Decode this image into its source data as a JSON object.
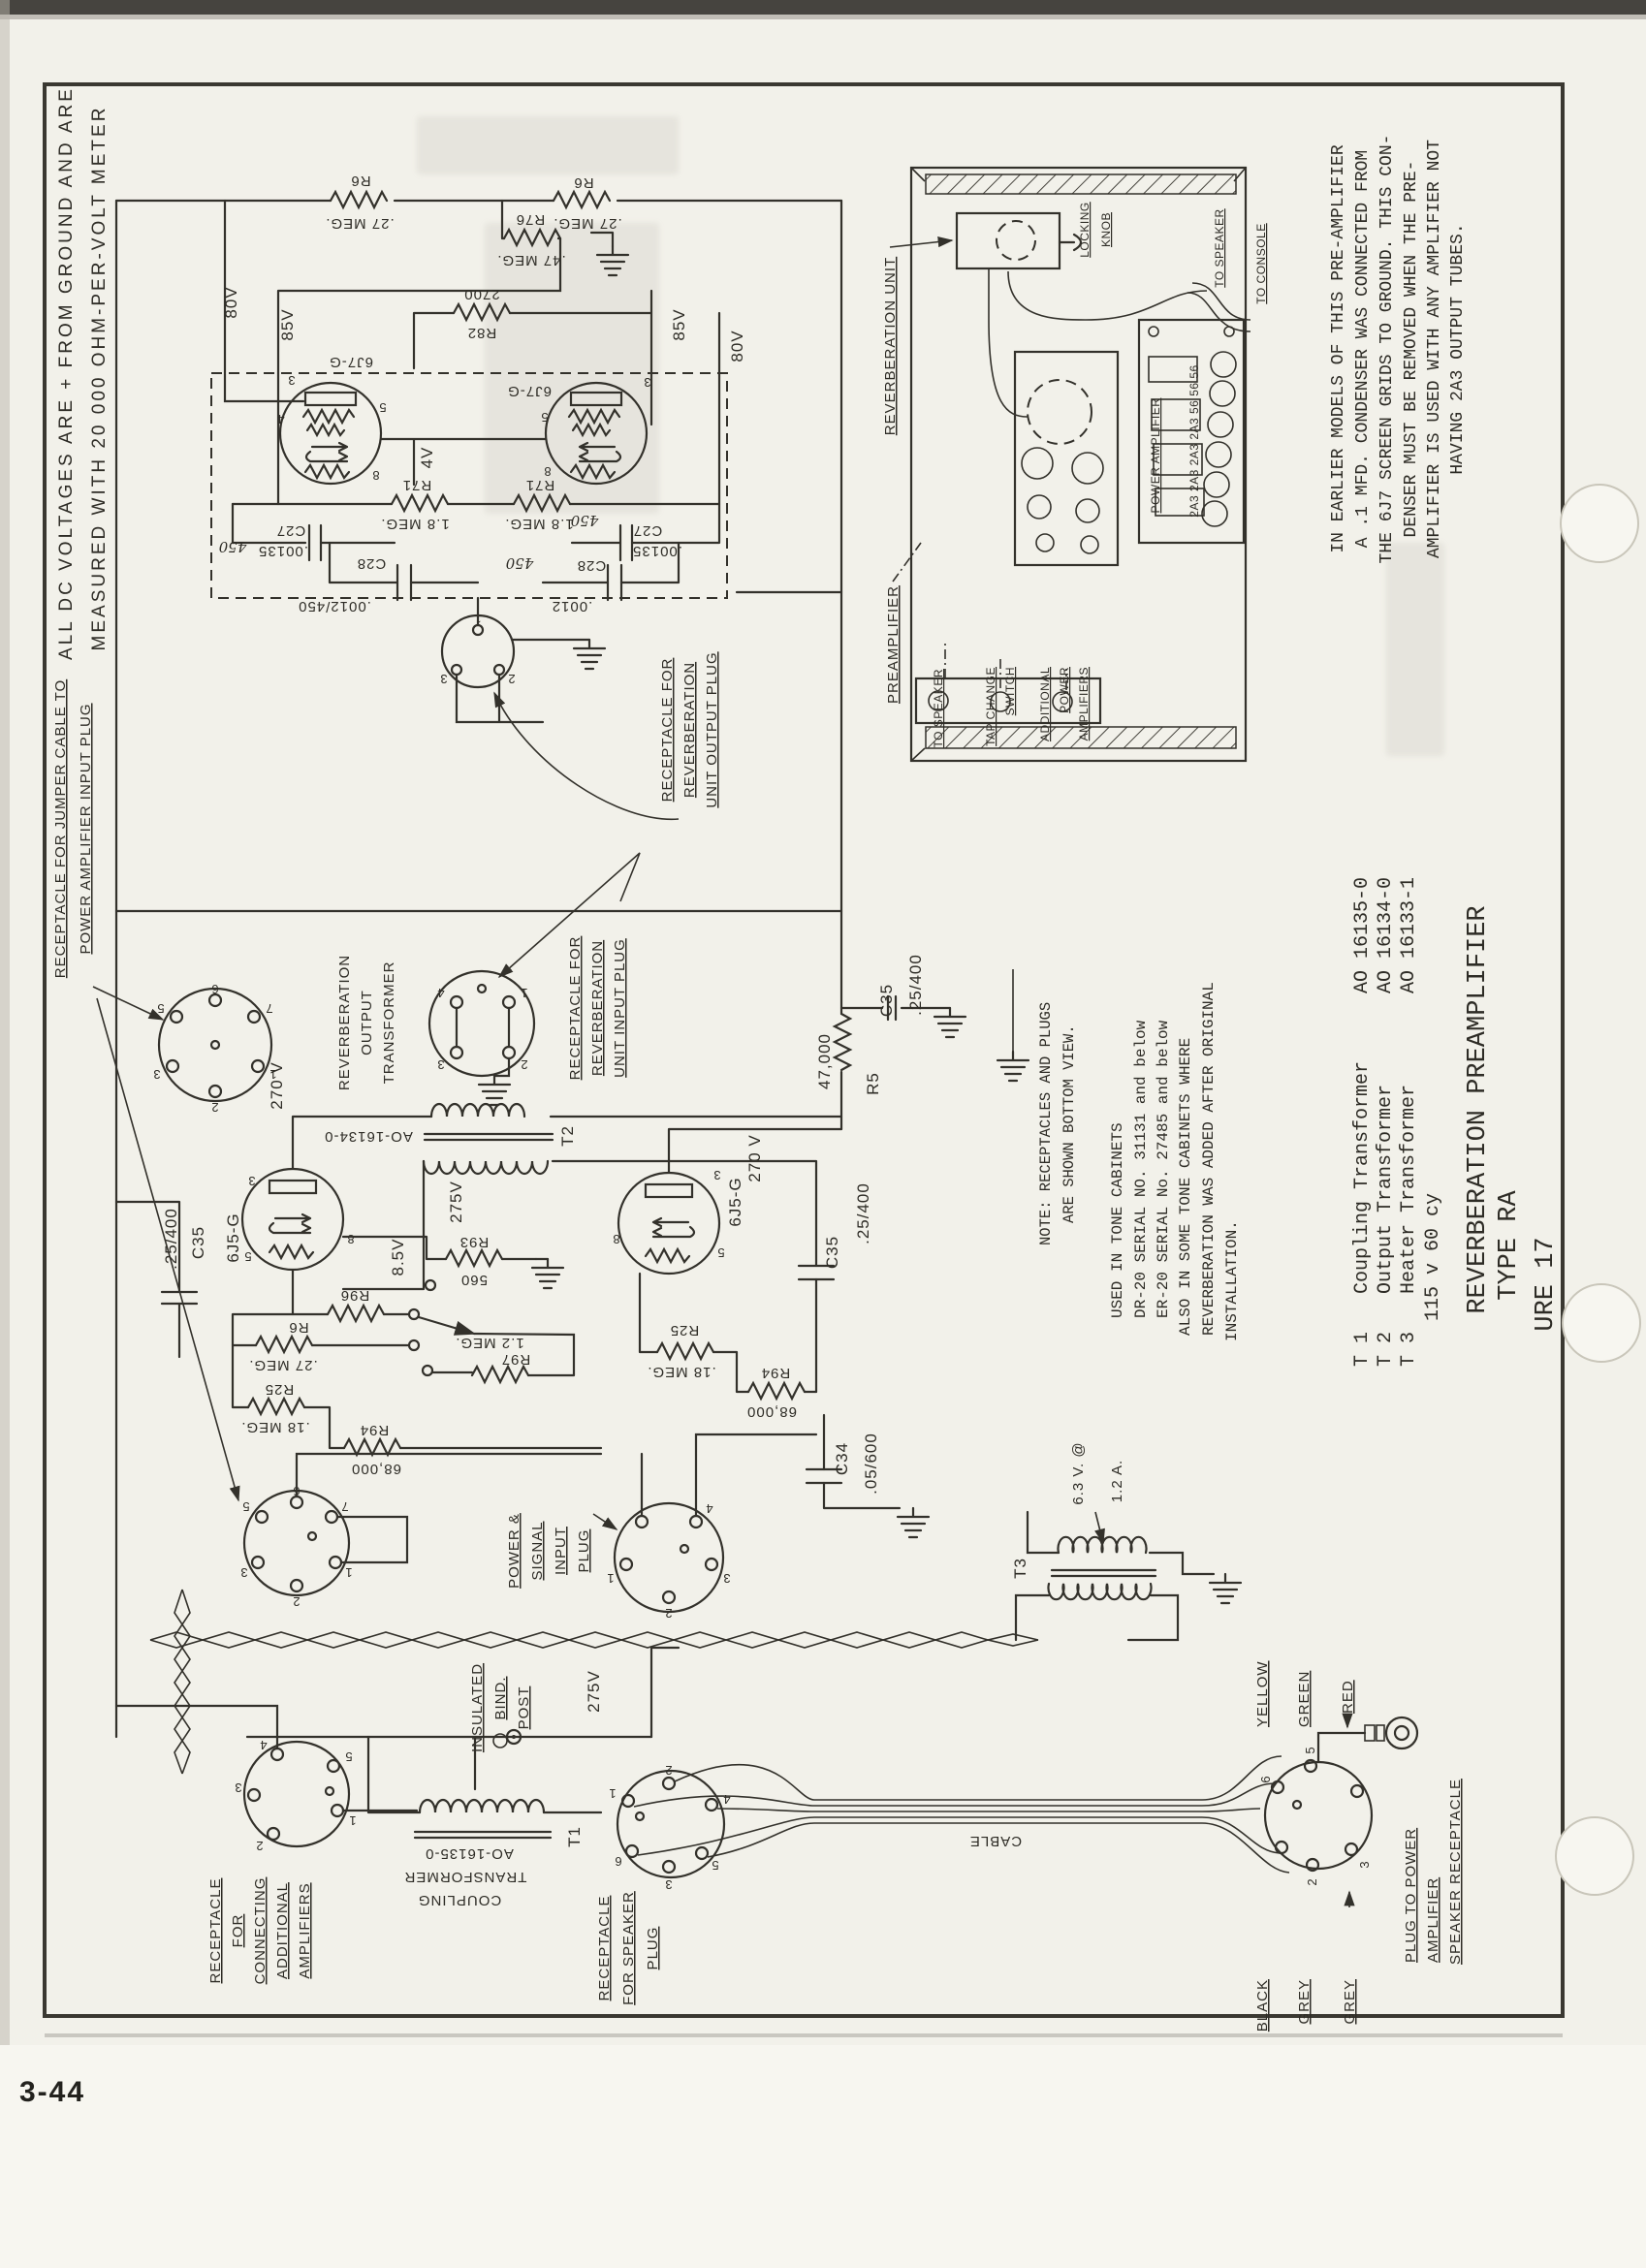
{
  "page": {
    "number": "3-44"
  },
  "caption": {
    "title": "REVERBERATION PREAMPLIFIER",
    "type": "TYPE RA",
    "figure": "URE 17"
  },
  "header": {
    "line1": "ALL DC VOLTAGES ARE + FROM GROUND AND ARE",
    "line2": "MEASURED WITH 20 000 OHM-PER-VOLT METER"
  },
  "notes": {
    "earlier_models": [
      "IN EARLIER MODELS OF THIS PRE-AMPLIFIER",
      "A .1 MFD. CONDENSER WAS CONNECTED FROM",
      "THE 6J7 SCREEN GRIDS TO GROUND.  THIS CON-",
      "DENSER MUST BE REMOVED WHEN THE PRE-",
      "AMPLIFIER IS USED WITH ANY AMPLIFIER NOT",
      "HAVING 2A3 OUTPUT TUBES."
    ],
    "bottom_view": [
      "NOTE:  RECEPTACLES AND PLUGS",
      "ARE SHOWN BOTTOM VIEW."
    ],
    "used_in": [
      "USED IN TONE CABINETS",
      "DR-20  SERIAL NO. 31131 and below",
      "ER-20  SERIAL No. 27485 and below",
      "ALSO IN SOME TONE CABINETS WHERE",
      "REVERBERATION WAS ADDED AFTER ORIGINAL",
      "INSTALLATION."
    ]
  },
  "table": {
    "rows": [
      {
        "id": "T 1",
        "name": "Coupling Transformer",
        "part": "AO 16135-0"
      },
      {
        "id": "T 2",
        "name": "Output Transformer",
        "part": "AO 16134-0"
      },
      {
        "id": "T 3",
        "name": "Heater Transformer",
        "part": "AO 16133-1"
      }
    ],
    "footer": "115 v 60 cy"
  },
  "callouts": {
    "jumper": [
      "RECEPTACLE FOR JUMPER CABLE TO",
      "POWER AMPLIFIER INPUT PLUG"
    ],
    "reverb_out_receptacle": [
      "RECEPTACLE FOR",
      "REVERBERATION",
      "UNIT OUTPUT PLUG"
    ],
    "reverb_out_transformer": [
      "REVERBERATION",
      "OUTPUT",
      "TRANSFORMER"
    ],
    "reverb_in_receptacle": [
      "RECEPTACLE FOR",
      "REVERBERATION",
      "UNIT INPUT PLUG"
    ],
    "power_signal_plug": [
      "POWER &",
      "SIGNAL",
      "INPUT",
      "PLUG"
    ],
    "bind_post": [
      "INSULATED",
      "BIND.",
      "POST"
    ],
    "additional_amps": [
      "RECEPTACLE",
      "FOR",
      "CONNECTING",
      "ADDITIONAL",
      "AMPLIFIERS"
    ],
    "speaker_receptacle": [
      "RECEPTACLE",
      "FOR SPEAKER",
      "PLUG"
    ],
    "power_amp_plug": [
      "PLUG TO POWER",
      "AMPLIFIER",
      "SPEAKER RECEPTACLE"
    ],
    "cable": "CABLE"
  },
  "illustration": {
    "reverberation_unit": "REVERBERATION UNIT",
    "locking_knob": [
      "LOCKING",
      "KNOB"
    ],
    "to_speaker": "TO SPEAKER",
    "to_console": "TO CONSOLE",
    "power_amplifier": "POWER AMPLIFIER",
    "output_tubes": "2A3 2A3 2A3 2A3 56 56 56",
    "preamplifier": "PREAMPLIFIER",
    "to_speaker_lower": "TO SPEAKER",
    "tap_change_switch": [
      "TAP CHANGE",
      "SWITCH"
    ],
    "additional_power_amplifiers": [
      "ADDITIONAL",
      "POWER",
      "AMPLIFIERS"
    ]
  },
  "tubes": {
    "pentode": "6J7-G",
    "triode": "6J5-G"
  },
  "transformers": {
    "t1": "T1",
    "t2": "T2",
    "t3": "T3",
    "t1_label": [
      "COUPLING",
      "TRANSFORMER",
      "AO-16135-0"
    ],
    "t2_part": "AO-16134-0",
    "heater_rating": [
      "6.3 V. @",
      "1.2 A."
    ]
  },
  "voltages": {
    "v80": "80V",
    "v85": "85V",
    "v4": "4V",
    "v270": "270 V",
    "v275": "275V",
    "v8_5": "8.5V"
  },
  "components": {
    "r6": {
      "name": "R6",
      "value": ".27 MEG."
    },
    "r76": {
      "name": "R76",
      "value": ".47 MEG."
    },
    "r82": {
      "name": "R82",
      "value": "2700"
    },
    "r71": {
      "name": "R71",
      "value": "1.8 MEG."
    },
    "c27": {
      "name": "C27",
      "value": ".00135"
    },
    "c28": {
      "name": "C28",
      "value": ".0012/450"
    },
    "c28_right": {
      "name": "C28",
      "value": ".0012"
    },
    "r5": {
      "name": "R5",
      "value": "47,000"
    },
    "c35": {
      "name": "C35",
      "value": ".25/400"
    },
    "c34": {
      "name": "C34",
      "value": ".05/600"
    },
    "r93": {
      "name": "R93",
      "value": "560"
    },
    "r96": {
      "name": "R96",
      "value": ""
    },
    "r97": {
      "name": "R97",
      "value": "1.2 MEG."
    },
    "r25": {
      "name": "R25",
      "value": ".18 MEG."
    },
    "r94": {
      "name": "R94",
      "value": "68,000"
    },
    "script450": "450"
  },
  "pins": {
    "p1": "1",
    "p2": "2",
    "p3": "3",
    "p4": "4",
    "p5": "5",
    "p6": "6",
    "p7": "7",
    "p8": "8"
  },
  "wire_colors": [
    "YELLOW",
    "GREEN",
    "RED",
    "BLACK",
    "GREY",
    "GREY"
  ]
}
